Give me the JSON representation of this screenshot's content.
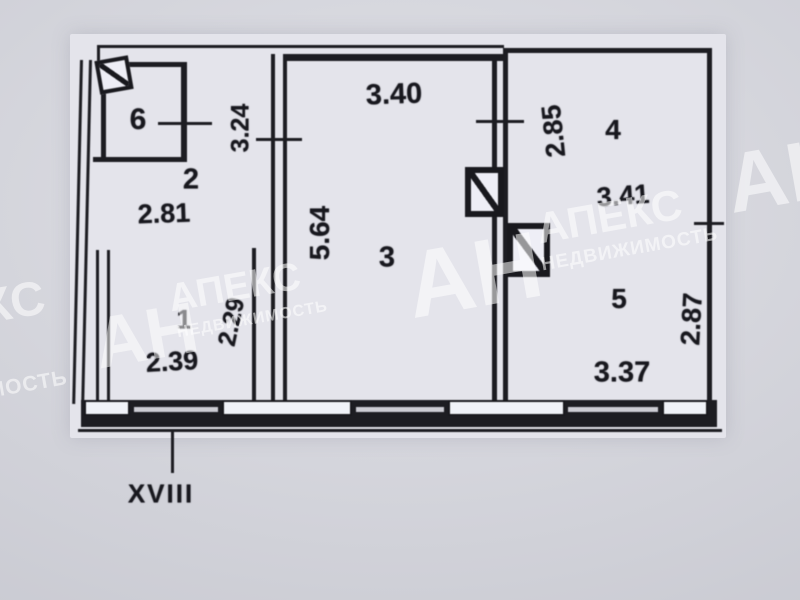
{
  "plan": {
    "section_label": "XVIII",
    "rooms": [
      {
        "number": "6"
      },
      {
        "number": "2",
        "width_m": "2.81",
        "depth_m": "3.24"
      },
      {
        "number": "1",
        "width_m": "2.39",
        "depth_m": "2.29"
      },
      {
        "number": "3",
        "width_m": "3.40",
        "depth_m": "5.64"
      },
      {
        "number": "4",
        "width_m": "3.41",
        "depth_m": "2.85"
      },
      {
        "number": "5",
        "width_m": "3.37",
        "depth_m": "2.87"
      }
    ]
  },
  "watermark": {
    "abbr": "АН",
    "name": "АПЕКС",
    "subtitle": "НЕДВИЖИМОСТЬ",
    "color": "#ffffff"
  },
  "colors": {
    "wall": "#212126",
    "paper": "#e4e4eb",
    "photo_background": "#d3d4dc"
  }
}
